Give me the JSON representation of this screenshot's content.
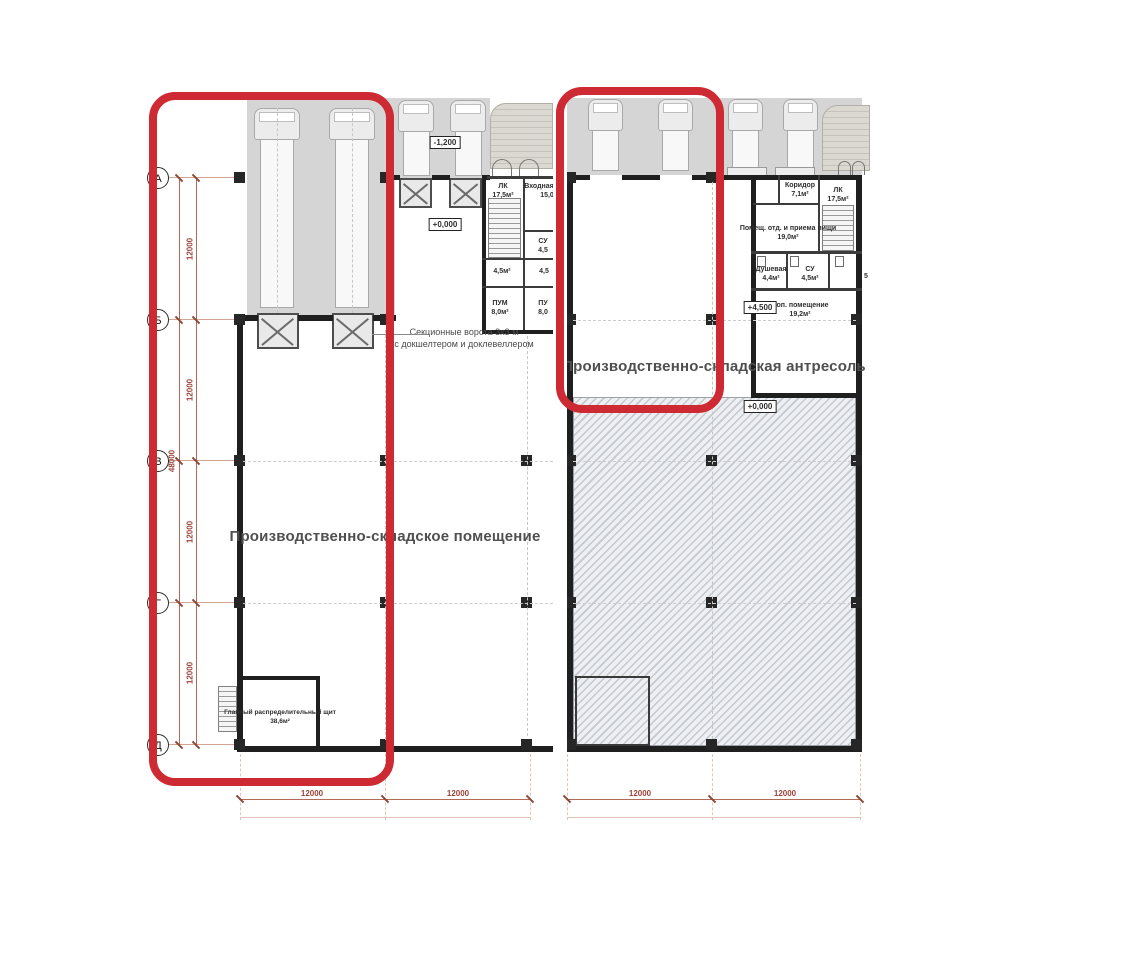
{
  "colors": {
    "highlight": "#ce2a33",
    "dimension": "#9b4238",
    "wall": "#1f1f1f",
    "apron": "#d5d5d5"
  },
  "axes": {
    "labels": [
      "А",
      "Б",
      "В",
      "Г",
      "Д"
    ],
    "total": "48000",
    "segments": [
      "12000",
      "12000",
      "12000",
      "12000"
    ]
  },
  "plan_left": {
    "title": "Производственно-складское помещение",
    "gate_note": [
      "Секционные ворота 3х3 м",
      "с докшелтером и доклевеллером"
    ],
    "elev_minus": "-1,200",
    "elev_zero": "+0,000",
    "bottom_dims": [
      "12000",
      "12000"
    ],
    "rooms": {
      "lk": {
        "name": "ЛК",
        "area": "17,5м²"
      },
      "vhod": {
        "name": "Входная",
        "area": "15,0"
      },
      "su": {
        "name": "СУ",
        "area": "4,5"
      },
      "r45a": {
        "area": "4,5м²"
      },
      "r45b": {
        "area": "4,5"
      },
      "pum1": {
        "name": "ПУМ",
        "area": "8,0м²"
      },
      "pum2": {
        "name": "ПУ",
        "area": "8,0"
      },
      "board": {
        "name": "Главный распределительный щит",
        "area": "38,6м²"
      }
    }
  },
  "plan_right": {
    "title": "Производственно-складская антресоль",
    "elev_plus": "+4,500",
    "elev_zero": "+0,000",
    "bottom_dims": [
      "12000",
      "12000"
    ],
    "rooms": {
      "koridor": {
        "name": "Коридор",
        "area": "7,1м²"
      },
      "lk": {
        "name": "ЛК",
        "area": "17,5м²"
      },
      "pom": {
        "name": "Помещ. отд. и приема пищи",
        "area": "19,0м²"
      },
      "dush": {
        "name": "Душевая",
        "area": "4,4м²"
      },
      "su": {
        "name": "СУ",
        "area": "4,5м²"
      },
      "cut": {
        "area": "5"
      },
      "dop": {
        "name": "Доп. помещение",
        "area": "19,2м²"
      }
    }
  }
}
